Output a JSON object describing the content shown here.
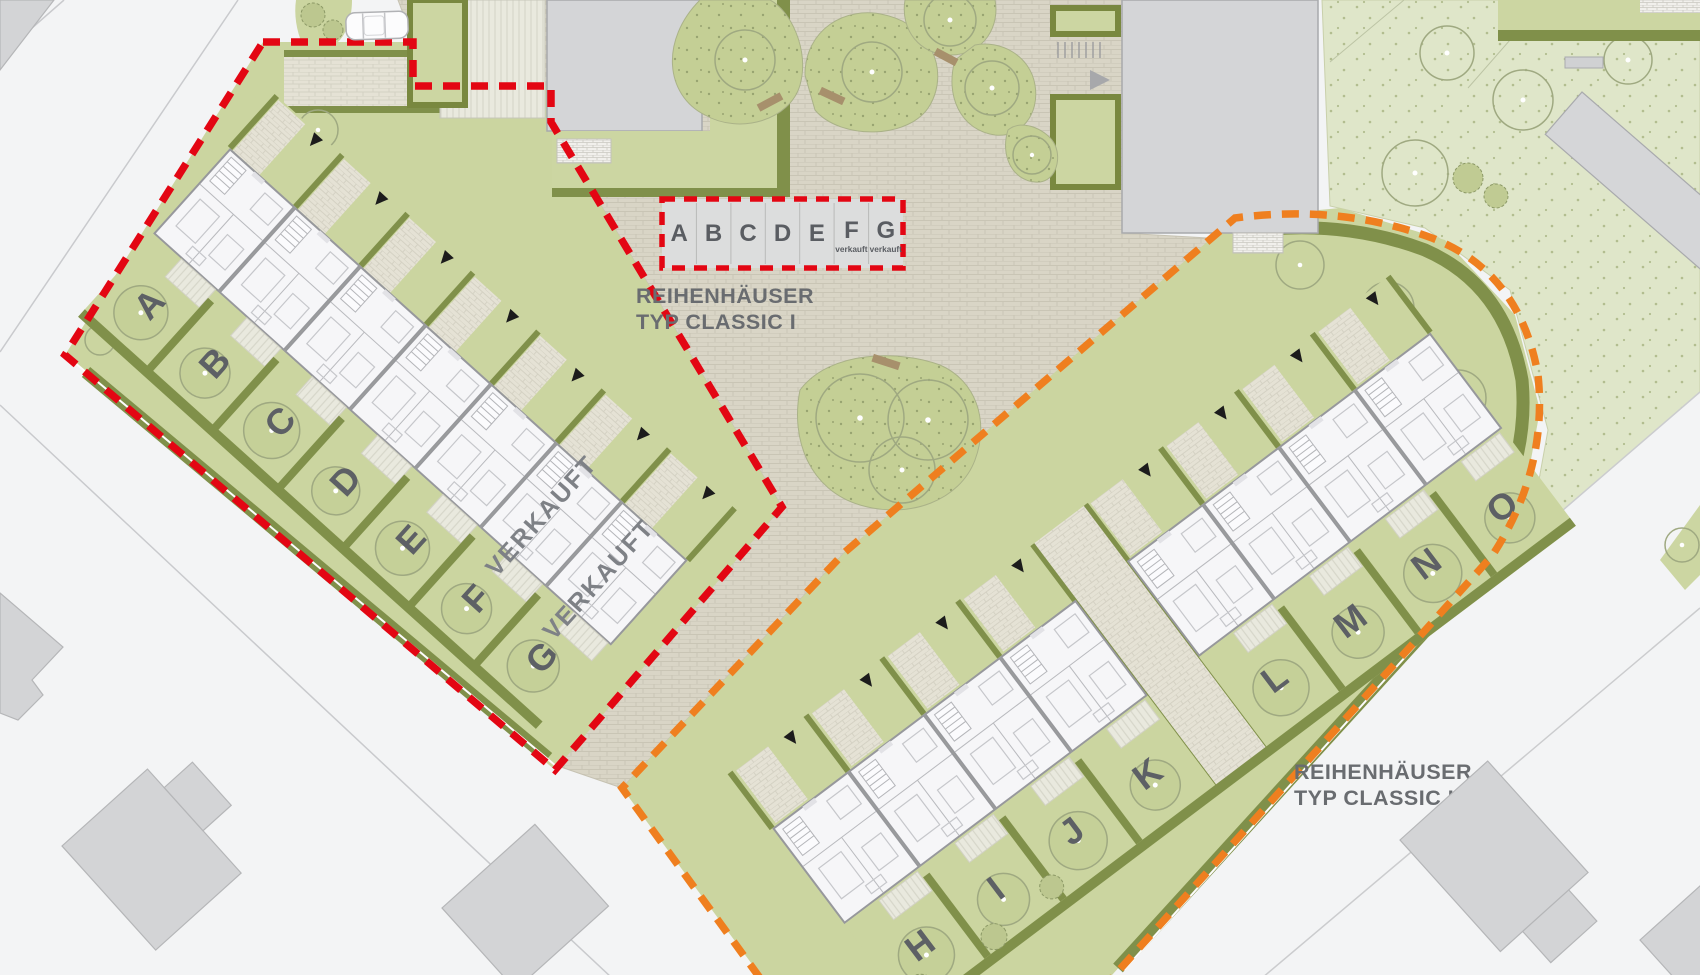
{
  "plan": {
    "legend": {
      "units": [
        {
          "label": "A",
          "status": ""
        },
        {
          "label": "B",
          "status": ""
        },
        {
          "label": "C",
          "status": ""
        },
        {
          "label": "D",
          "status": ""
        },
        {
          "label": "E",
          "status": ""
        },
        {
          "label": "F",
          "status": "verkauft"
        },
        {
          "label": "G",
          "status": "verkauft"
        }
      ]
    },
    "titles": {
      "classic1_line1": "REIHENHÄUSER",
      "classic1_line2": "TYP CLASSIC I",
      "classic2_line1": "REIHENHÄUSER",
      "classic2_line2": "TYP CLASSIC II"
    },
    "rows": {
      "classic1": {
        "boundary_color": "#e30613",
        "plots": [
          {
            "label": "A"
          },
          {
            "label": "B"
          },
          {
            "label": "C"
          },
          {
            "label": "D"
          },
          {
            "label": "E"
          },
          {
            "label": "F"
          },
          {
            "label": "G"
          }
        ],
        "sold": [
          {
            "label": "VERKAUFT"
          },
          {
            "label": "VERKAUFT"
          }
        ]
      },
      "classic2": {
        "boundary_color": "#ef7f1f",
        "plots": [
          {
            "label": "H"
          },
          {
            "label": "I"
          },
          {
            "label": "J"
          },
          {
            "label": "K"
          },
          {
            "label": "L"
          },
          {
            "label": "M"
          },
          {
            "label": "N"
          },
          {
            "label": "O"
          }
        ]
      }
    },
    "colors": {
      "red": "#e30613",
      "orange": "#ef7f1f",
      "garden_green": "#cbd5a0",
      "hedge_olive": "#80904a",
      "plaza_beige": "#d9d5c6",
      "building_gray": "#d4d5d7",
      "lawn_pale": "#dfe6c9"
    },
    "icons": {
      "entrance_arrow": "black-triangle",
      "direction_arrow": "gray-triangle"
    }
  }
}
